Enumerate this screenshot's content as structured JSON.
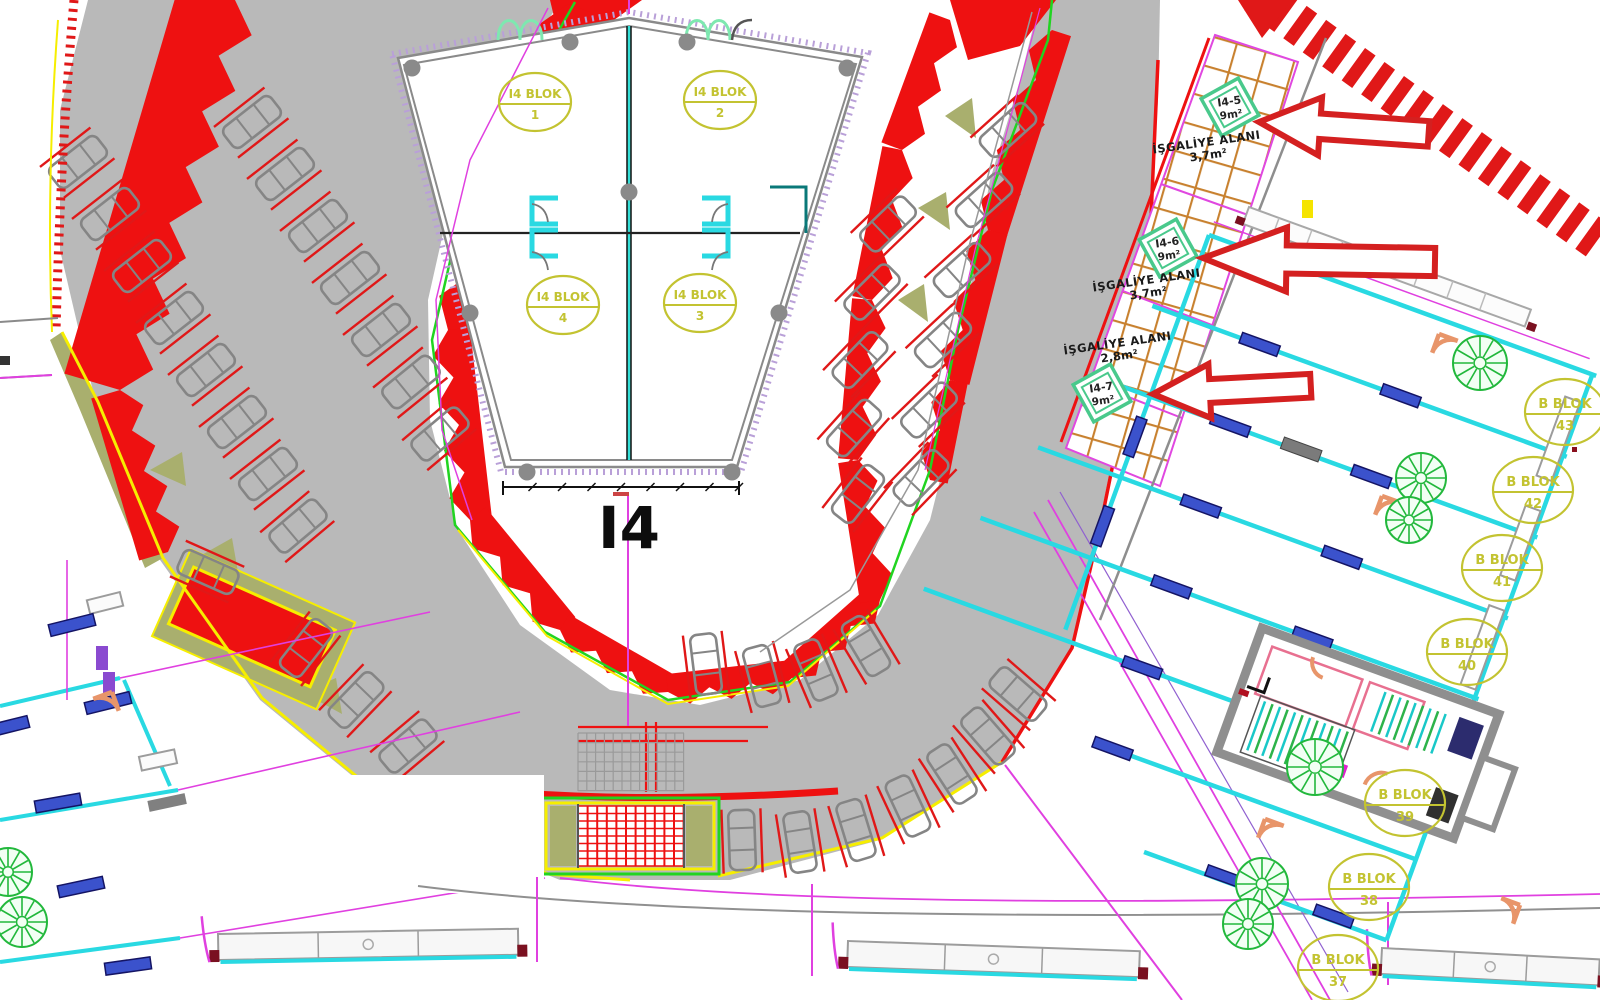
{
  "palette": {
    "red": "#ee1111",
    "arrow_red": "#d42020",
    "road_gray": "#b9b9b9",
    "line_gray": "#8a8a8a",
    "green": "#21d421",
    "yellow": "#f6ee00",
    "khaki": "#a9af6e",
    "cyan": "#29d9e2",
    "window_blue": "#3b52cc",
    "magenta": "#e040e0",
    "tan_hatch": "#c8812f",
    "mint": "#49c98c",
    "label_olive": "#c3c331",
    "tree_green": "#22b83c",
    "door_orange": "#e8956a",
    "maroon": "#7a1020"
  },
  "building": {
    "title": "I4",
    "blocks": [
      {
        "label": "I4 BLOK",
        "num": "1",
        "x": 535,
        "y": 102
      },
      {
        "label": "I4 BLOK",
        "num": "2",
        "x": 720,
        "y": 100
      },
      {
        "label": "I4 BLOK",
        "num": "4",
        "x": 563,
        "y": 305
      },
      {
        "label": "I4 BLOK",
        "num": "3",
        "x": 700,
        "y": 303
      }
    ]
  },
  "b_blocks": [
    {
      "label": "B BLOK",
      "num": "43",
      "x": 1565,
      "y": 412
    },
    {
      "label": "B BLOK",
      "num": "42",
      "x": 1533,
      "y": 490
    },
    {
      "label": "B BLOK",
      "num": "41",
      "x": 1502,
      "y": 568
    },
    {
      "label": "B BLOK",
      "num": "40",
      "x": 1467,
      "y": 652
    },
    {
      "label": "B BLOK",
      "num": "39",
      "x": 1405,
      "y": 803
    },
    {
      "label": "B BLOK",
      "num": "38",
      "x": 1369,
      "y": 887
    },
    {
      "label": "B BLOK",
      "num": "37",
      "x": 1338,
      "y": 968
    }
  ],
  "occupancy": {
    "areas": [
      {
        "code": "I4-5",
        "size": "9m²",
        "dx": 1230,
        "dy": 107,
        "label": "İŞGALİYE ALANI",
        "area": "3,7m²",
        "lx": 1207,
        "ly": 146,
        "rot": -8
      },
      {
        "code": "I4-6",
        "size": "9m²",
        "dx": 1168,
        "dy": 248,
        "label": "İŞGALİYE ALANI",
        "area": "3,7m²",
        "lx": 1147,
        "ly": 284,
        "rot": -8
      },
      {
        "code": "I4-7",
        "size": "9m²",
        "dx": 1102,
        "dy": 393,
        "label": "İŞGALİYE ALANI",
        "area": "2,8m²",
        "lx": 1118,
        "ly": 347,
        "rot": -8
      }
    ]
  },
  "arrows": [
    {
      "x": 1259,
      "y": 122,
      "len": 170,
      "h": 58,
      "rot": 4
    },
    {
      "x": 1203,
      "y": 258,
      "len": 232,
      "h": 64,
      "rot": 1
    },
    {
      "x": 1153,
      "y": 394,
      "len": 158,
      "h": 54,
      "rot": -3
    }
  ],
  "plan": {
    "cars": [
      [
        78,
        162,
        -38
      ],
      [
        110,
        214,
        -38
      ],
      [
        142,
        266,
        -38
      ],
      [
        174,
        318,
        -38
      ],
      [
        206,
        370,
        -38
      ],
      [
        237,
        422,
        -38
      ],
      [
        268,
        474,
        -38
      ],
      [
        298,
        526,
        -40
      ],
      [
        252,
        122,
        -38
      ],
      [
        285,
        174,
        -38
      ],
      [
        318,
        226,
        -38
      ],
      [
        350,
        278,
        -38
      ],
      [
        381,
        330,
        -38
      ],
      [
        411,
        382,
        -39
      ],
      [
        440,
        434,
        -40
      ],
      [
        1008,
        130,
        -42
      ],
      [
        984,
        200,
        -42
      ],
      [
        962,
        270,
        -42
      ],
      [
        943,
        340,
        -43
      ],
      [
        929,
        410,
        -44
      ],
      [
        921,
        478,
        -46
      ],
      [
        888,
        224,
        -44
      ],
      [
        872,
        292,
        -45
      ],
      [
        860,
        360,
        -46
      ],
      [
        854,
        428,
        -48
      ],
      [
        858,
        494,
        -52
      ],
      [
        306,
        648,
        -52
      ],
      [
        356,
        700,
        -46
      ],
      [
        408,
        746,
        -40
      ],
      [
        208,
        572,
        24
      ],
      [
        742,
        840,
        -92
      ],
      [
        800,
        842,
        -99
      ],
      [
        856,
        830,
        -107
      ],
      [
        908,
        806,
        -115
      ],
      [
        952,
        774,
        -123
      ],
      [
        988,
        736,
        -131
      ],
      [
        1018,
        694,
        -139
      ],
      [
        706,
        664,
        -97
      ],
      [
        762,
        676,
        -105
      ],
      [
        816,
        670,
        -113
      ],
      [
        866,
        646,
        -121
      ]
    ],
    "trees": [
      [
        600,
        214,
        23
      ],
      [
        663,
        214,
        23
      ],
      [
        600,
        254,
        23
      ],
      [
        663,
        254,
        23
      ],
      [
        1480,
        363,
        27
      ],
      [
        1421,
        478,
        25
      ],
      [
        1409,
        520,
        23
      ],
      [
        1315,
        767,
        28
      ],
      [
        1262,
        884,
        26
      ],
      [
        1248,
        924,
        25
      ],
      [
        8,
        872,
        24
      ],
      [
        22,
        922,
        25
      ]
    ],
    "strips": [
      {
        "x1": 235,
        "y1": 0,
        "x2": 120,
        "y2": 390,
        "w": 58,
        "amp": 26,
        "n": 7,
        "flip": -1
      },
      {
        "x1": 120,
        "y1": 390,
        "x2": 168,
        "y2": 552,
        "w": 30,
        "amp": 18,
        "n": 4,
        "flip": -1
      },
      {
        "x1": 568,
        "y1": 4,
        "x2": 448,
        "y2": 330,
        "w": 24,
        "amp": 20,
        "n": 6,
        "flip": 1
      },
      {
        "x1": 448,
        "y1": 330,
        "x2": 470,
        "y2": 520,
        "w": 22,
        "amp": 18,
        "n": 4,
        "flip": 1
      },
      {
        "x1": 470,
        "y1": 520,
        "x2": 560,
        "y2": 630,
        "w": 20,
        "amp": 16,
        "n": 3,
        "flip": 1
      },
      {
        "x1": 560,
        "y1": 630,
        "x2": 668,
        "y2": 692,
        "w": 18,
        "amp": 14,
        "n": 3,
        "flip": 1
      },
      {
        "x1": 668,
        "y1": 692,
        "x2": 792,
        "y2": 678,
        "w": 18,
        "amp": 14,
        "n": 3,
        "flip": 1
      },
      {
        "x1": 792,
        "y1": 678,
        "x2": 880,
        "y2": 600,
        "w": 18,
        "amp": 14,
        "n": 3,
        "flip": 1
      },
      {
        "x1": 880,
        "y1": 600,
        "x2": 858,
        "y2": 460,
        "w": 20,
        "amp": 16,
        "n": 3,
        "flip": 1
      },
      {
        "x1": 858,
        "y1": 460,
        "x2": 872,
        "y2": 300,
        "w": 20,
        "amp": 16,
        "n": 3,
        "flip": 1
      },
      {
        "x1": 872,
        "y1": 300,
        "x2": 902,
        "y2": 150,
        "w": 20,
        "amp": 16,
        "n": 3,
        "flip": 1
      },
      {
        "x1": 902,
        "y1": 150,
        "x2": 950,
        "y2": 20,
        "w": 22,
        "amp": 16,
        "n": 3,
        "flip": 1
      },
      {
        "x1": 1052,
        "y1": 30,
        "x2": 988,
        "y2": 230,
        "w": 20,
        "amp": 16,
        "n": 4,
        "flip": 1
      },
      {
        "x1": 988,
        "y1": 230,
        "x2": 950,
        "y2": 380,
        "w": 20,
        "amp": 16,
        "n": 3,
        "flip": 1
      },
      {
        "x1": 950,
        "y1": 380,
        "x2": 930,
        "y2": 480,
        "w": 18,
        "amp": 14,
        "n": 2,
        "flip": 1
      }
    ],
    "khaki_wedges": [
      [
        150,
        470,
        182,
        452,
        186,
        486
      ],
      [
        200,
        556,
        232,
        538,
        238,
        572
      ],
      [
        945,
        116,
        972,
        98,
        976,
        138
      ],
      [
        918,
        208,
        946,
        192,
        950,
        230
      ],
      [
        898,
        300,
        924,
        284,
        928,
        322
      ],
      [
        250,
        640,
        284,
        624,
        290,
        662
      ],
      [
        302,
        692,
        336,
        678,
        342,
        714
      ]
    ],
    "windows": [
      [
        72,
        625,
        -14
      ],
      [
        108,
        703,
        -14
      ],
      [
        6,
        727,
        -14
      ],
      [
        58,
        803,
        -10
      ],
      [
        81,
        887,
        -12
      ],
      [
        128,
        966,
        -8
      ]
    ],
    "door_arcs": [
      [
        1439,
        334,
        110
      ],
      [
        1382,
        496,
        110
      ],
      [
        1265,
        819,
        110
      ],
      [
        1520,
        905,
        200
      ],
      [
        112,
        692,
        160
      ]
    ],
    "balconies": [
      {
        "x": 218,
        "y": 934,
        "w": 300,
        "rot": -1
      },
      {
        "x": 848,
        "y": 941,
        "w": 292,
        "rot": 2
      },
      {
        "x": 1382,
        "y": 948,
        "w": 218,
        "rot": 3
      }
    ]
  }
}
